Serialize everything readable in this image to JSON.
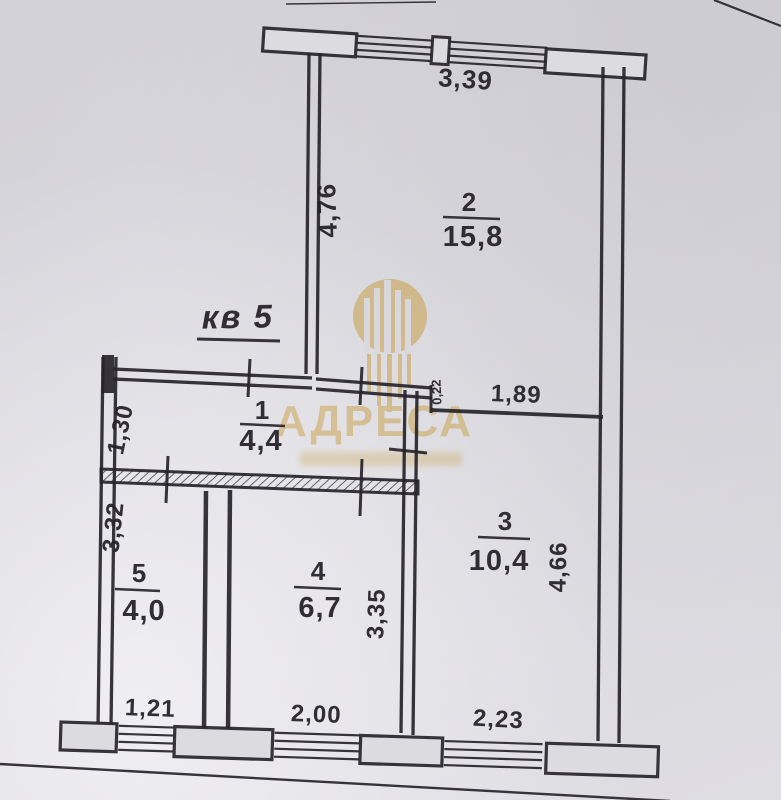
{
  "plan": {
    "title": "кв 5",
    "rooms": {
      "r1": {
        "number": "1",
        "area": "4,4"
      },
      "r2": {
        "number": "2",
        "area": "15,8"
      },
      "r3": {
        "number": "3",
        "area": "10,4"
      },
      "r4": {
        "number": "4",
        "area": "6,7"
      },
      "r5": {
        "number": "5",
        "area": "4,0"
      }
    },
    "dims": {
      "balcony_width": "3,39",
      "room2_left_height": "4,76",
      "room3_top_width": "1,89",
      "wall_step": "0,22",
      "hall_entry_height": "1,30",
      "room5_left_height": "3,32",
      "room4_right_height": "3,35",
      "room3_right_height": "4,66",
      "room5_window_width": "1,21",
      "room4_window_width": "2,00",
      "room3_window_width": "2,23"
    }
  },
  "watermark": {
    "brand": "АДРЕСА",
    "color": "#c79b3b"
  },
  "colors": {
    "paper": "#d8d7dc",
    "ink": "#26242a"
  }
}
